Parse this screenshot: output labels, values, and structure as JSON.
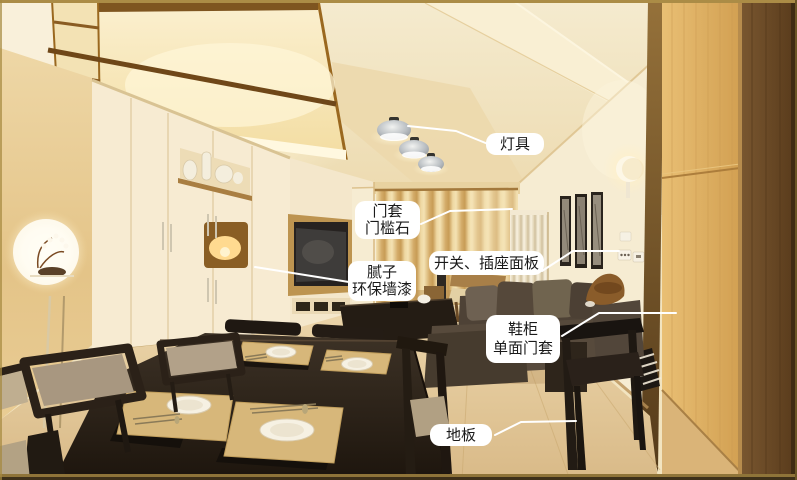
{
  "annotations": {
    "lighting": {
      "line1": "灯具"
    },
    "door_casing": {
      "line1": "门套",
      "line2": "门槛石"
    },
    "switch_socket": {
      "line1": "开关、插座面板"
    },
    "putty_paint": {
      "line1": "腻子",
      "line2": "环保墙漆"
    },
    "shoe_cabinet": {
      "line1": "鞋柜",
      "line2": "单面门套"
    },
    "floor": {
      "line1": "地板"
    }
  },
  "style": {
    "label_background": "#ffffff",
    "label_text_color": "#1a1a1a",
    "leader_line_color": "#ffffff",
    "frame_border_color": "#a8873e"
  }
}
